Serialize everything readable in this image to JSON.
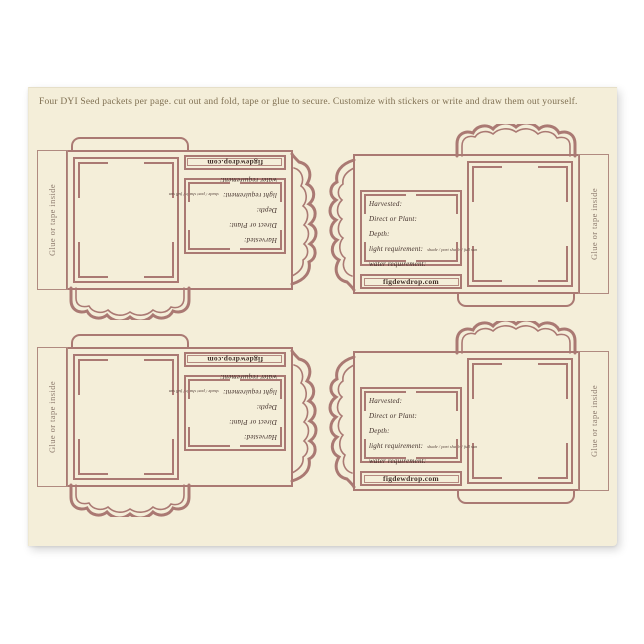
{
  "page": {
    "header_note": "Four DYI Seed packets per page. cut out and fold, tape or glue to secure. Customize with stickers or write and draw them out yourself."
  },
  "packet": {
    "glue_tab_label": "Glue or tape inside",
    "fields": [
      {
        "label": "Harvested:",
        "suffix": ""
      },
      {
        "label": "Direct or Plant:",
        "suffix": ""
      },
      {
        "label": "Depth:",
        "suffix": ""
      },
      {
        "label": "light requirement:",
        "suffix": "shade / part shade / full sun"
      },
      {
        "label": "water requirement:",
        "suffix": ""
      }
    ],
    "website": "figdewdrop.com"
  },
  "colors": {
    "accent_line": "#aa7973",
    "paper_cream": "#f4eed9",
    "ink": "#3f2d28",
    "header_text": "#7f6f51"
  },
  "layout_note": "four identical DIY seed packet cut-out templates, left column copies rotated 180 degrees"
}
